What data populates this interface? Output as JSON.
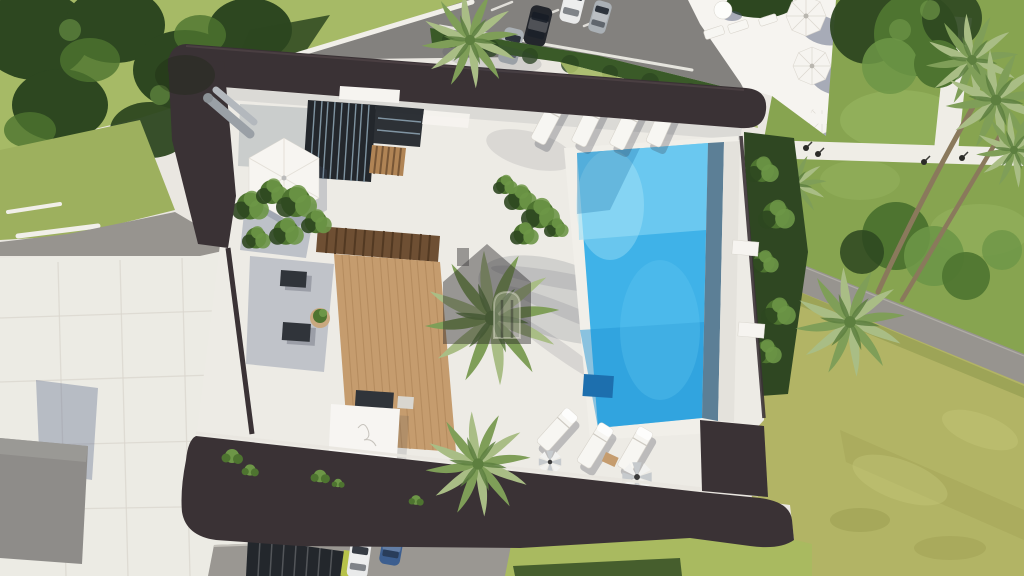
{
  "scene": {
    "type": "aerial-3d-architectural-render",
    "description": "Top-down aerial 3D rendering of a modern luxury villa with dark flat roof, courtyard with glass skylights, wooden deck and pergola, blue swimming pool with sun loungers and parasols, palm trees, surrounding roads with parked cars, neighbour terraces and landscaped lawns",
    "watermark_icon": "house-logo",
    "elements": [
      "villa-flat-roof",
      "courtyard-terrace",
      "glass-skylight",
      "hexagonal-canopy",
      "pergola",
      "wooden-deck",
      "swimming-pool",
      "infinity-edge",
      "pool-loungers",
      "closed-striped-parasols",
      "open-parasols",
      "palm-trees",
      "garden-bushes",
      "hedge",
      "top-road",
      "parked-cars",
      "driveway-cars",
      "neighbour-terrace",
      "lawns",
      "garden-paths",
      "street-lamps",
      "roof-planters",
      "vent-pipes",
      "white-canopy-square",
      "watermark-house-logo"
    ],
    "colors": {
      "pavement": "#eae7e1",
      "plaza": "#ecebe4",
      "tile-line": "#d9d5cd",
      "grass-top": "#a6ba66",
      "grass-slope": "#9db05e",
      "lawn-green": "#87a450",
      "lawn-yellow": "#b2b465",
      "grass-wedge": "#a9ba60",
      "foliage-dark": "#2d4720",
      "bush-mid": "#4e7430",
      "bush-light": "#6d9647",
      "hedge": "#3a5a28",
      "road-asphalt": "#83817e",
      "gravel": "#97948f",
      "driveway": "#9a9792",
      "curb": "#f1efe9",
      "white-structure": "#f6f4f0",
      "roof-dark": "#3a3235",
      "roof-edge": "#5a4c50",
      "courtyard": "#edebe5",
      "glass-dark": "#23272c",
      "louver-blue": "#8fa6b5",
      "wood-slat": "#b08455",
      "deck-wood": "#c59c6e",
      "deck-line": "#b2895c",
      "pergola-wood": "#6e4f33",
      "pergola-line": "#523922",
      "pool-rim": "#f1efe9",
      "pool-mid": "#3fb2e8",
      "pool-light": "#8edbf5",
      "pool-deep": "#2395d6",
      "pool-edge": "#5c7f96",
      "pool-mat": "#1d6fae",
      "pool-wall": "#e4e2dc",
      "shadow-blue": "rgba(82,98,134,0.38)",
      "shadow-soft": "rgba(60,66,80,0.28)",
      "terrace-shadow": "rgba(70,82,112,0.45)",
      "furniture-dark": "#30343a",
      "metal-gray": "#9aa0a6",
      "pot": "#c9a87f",
      "palm-mid": "#7f9e58",
      "palm-light": "#a9bd85",
      "palm-dark": "#5d7f3f",
      "trunk": "#8a795c",
      "car-dark": "#23262c",
      "car-white": "#e9eaea",
      "car-silver": "#aab0b5",
      "car-blue": "#3c5e8f",
      "parasol-gray": "#c6cacd",
      "lamp": "#2b2b28",
      "lime": "#b7c24a",
      "watermark": "rgba(38,35,38,0.5)",
      "watermark-light": "rgba(235,230,220,0.28)"
    }
  }
}
